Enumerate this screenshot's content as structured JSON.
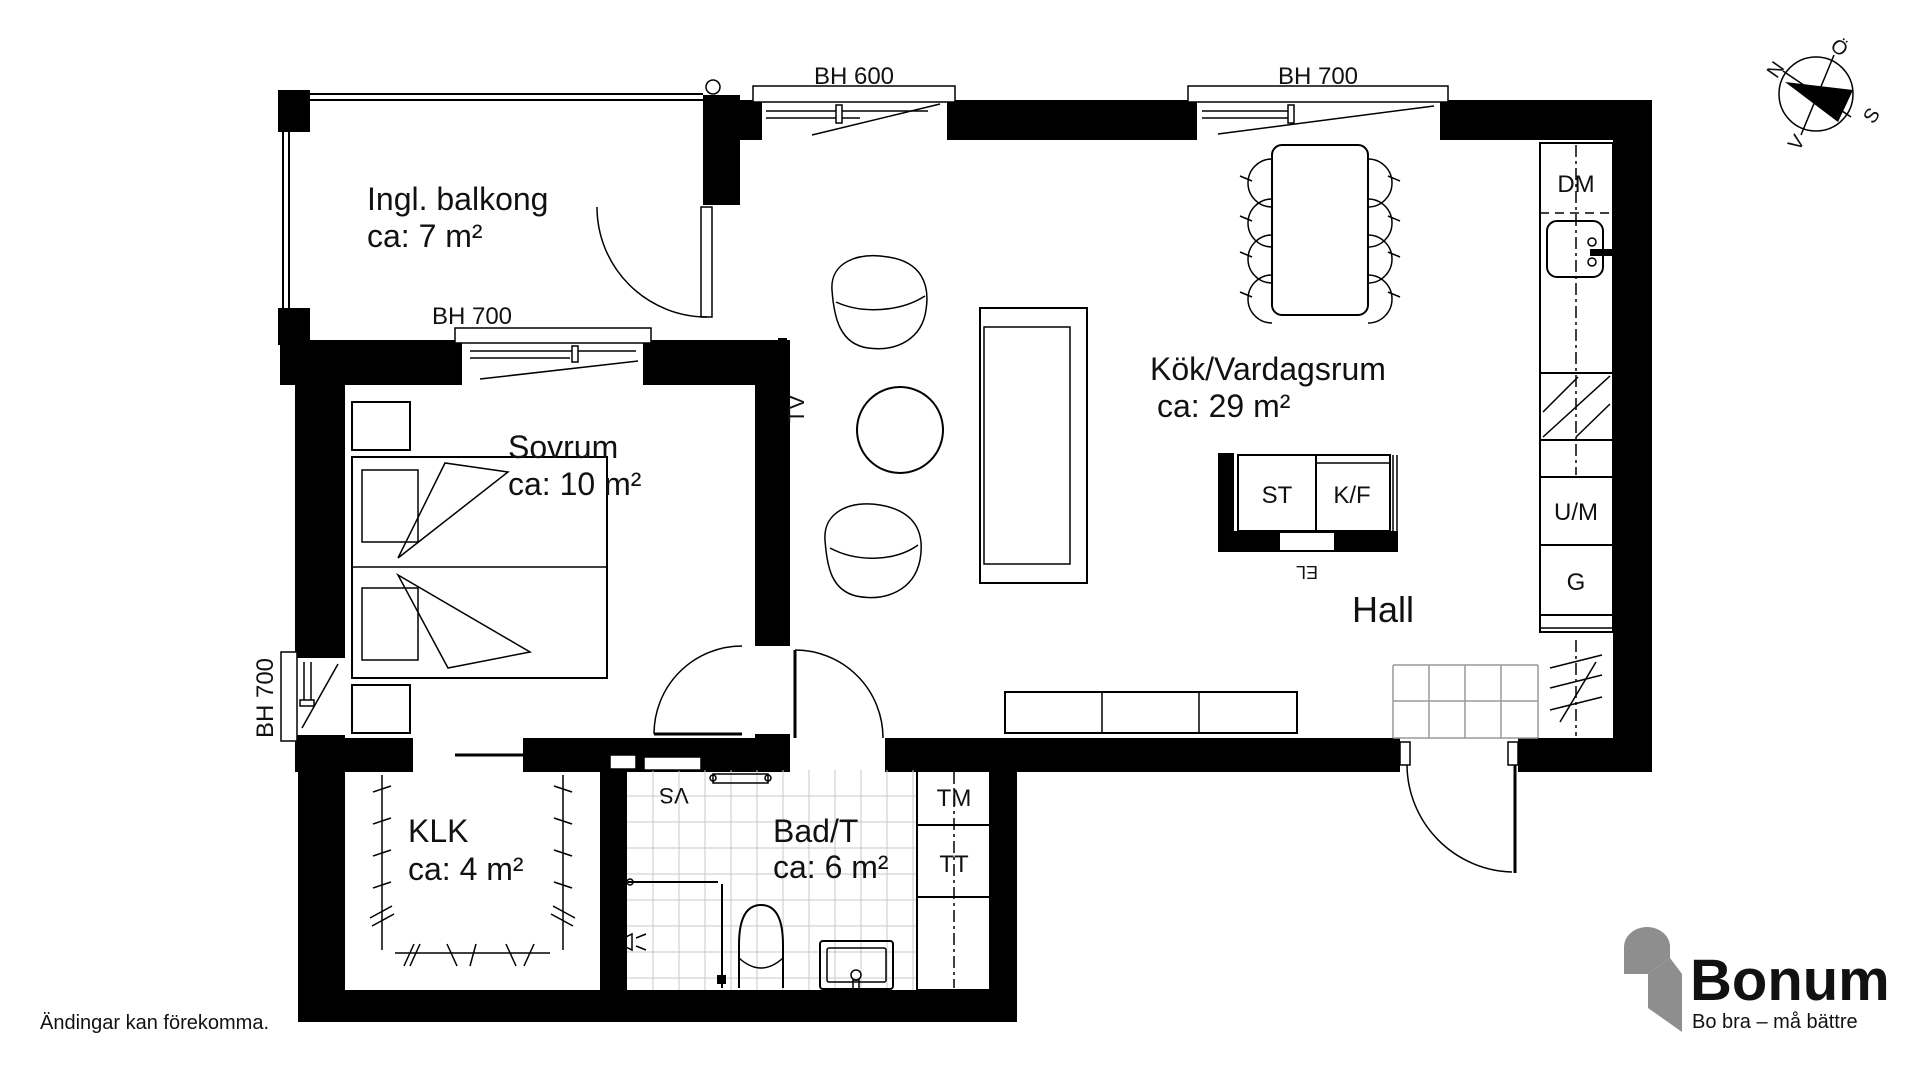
{
  "meta": {
    "disclaimer": "Ändingar kan förekomma."
  },
  "rooms": {
    "balcony": {
      "name": "Ingl. balkong",
      "area": "ca: 7 m²"
    },
    "bedroom": {
      "name": "Sovrum",
      "area": "ca: 10 m²"
    },
    "kitchen_living": {
      "name": "Kök/Vardagsrum",
      "area": "ca: 29 m²"
    },
    "closet": {
      "name": "KLK",
      "area": "ca: 4 m²"
    },
    "bathroom": {
      "name": "Bad/T",
      "area": "ca: 6 m²"
    },
    "hall": {
      "name": "Hall"
    }
  },
  "windows": {
    "top_left": "BH 600",
    "top_right": "BH 700",
    "balcony": "BH 700",
    "bedroom": "BH 700"
  },
  "fixtures": {
    "dishwasher": "DM",
    "micro_oven": "U/M",
    "wardrobe": "G",
    "cleaning_cabinet": "ST",
    "fridge_freezer": "K/F",
    "washing_machine": "TM",
    "dryer": "TT",
    "electrical": "EL",
    "water_cabinet": "VS",
    "tv": "TV"
  },
  "compass": {
    "north": "N",
    "south": "S",
    "east": "Ö",
    "west": "V"
  },
  "logo": {
    "brand": "Bonum",
    "tagline": "Bo bra – må bättre"
  },
  "colors": {
    "brand_orange": "#F49B1D",
    "brand_gray": "#8E8E8E",
    "wall": "#000000"
  }
}
